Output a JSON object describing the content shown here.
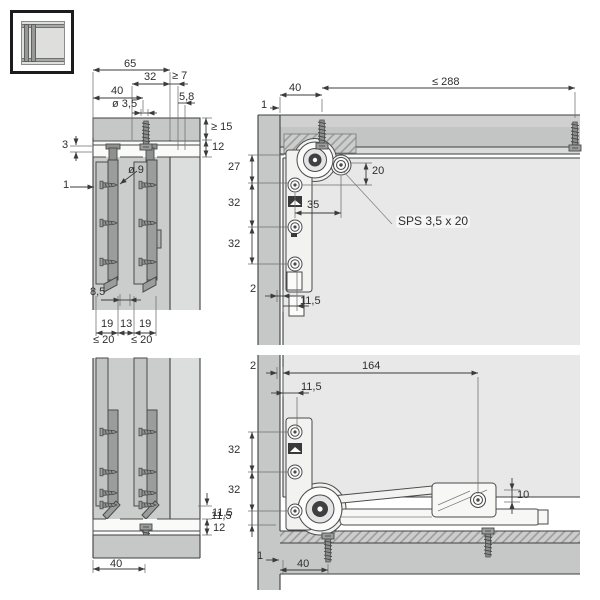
{
  "drawing_title": "Sliding door fitting installation drawing",
  "legend_icon": "sliding-door-cabinet-icon",
  "views": {
    "top_section": {
      "name": "top track cross-section",
      "labels": {
        "width_65": "65",
        "width_32": "32",
        "min_7": "≥ 7",
        "width_40": "40",
        "off_5_8": "5,8",
        "dia_3_5": "ø 3,5",
        "min_15": "≥ 15",
        "h_12": "12",
        "h_3": "3",
        "gap_1": "1",
        "dia_9": "ø 9",
        "off_8_5": "8,5",
        "t_19a": "19",
        "t_13": "13",
        "t_19b": "19",
        "max_20a": "≤ 20",
        "max_20b": "≤ 20"
      }
    },
    "top_side": {
      "name": "top fitting side view",
      "labels": {
        "w_40": "40",
        "gap_1": "1",
        "max_288": "≤ 288",
        "h_27": "27",
        "h_32a": "32",
        "h_32b": "32",
        "v_20": "20",
        "w_35": "35",
        "gap_2": "2",
        "off_11_5": "11,5"
      },
      "screw_note": "SPS 3,5 x 20"
    },
    "bottom_section": {
      "name": "bottom track cross-section",
      "labels": {
        "h_11_5": "11,5",
        "h_12": "12",
        "w_40": "40"
      }
    },
    "bottom_side": {
      "name": "bottom fitting side view",
      "labels": {
        "gap_2": "2",
        "w_164": "164",
        "off_11_5": "11,5",
        "h_32a": "32",
        "h_32b": "32",
        "h_11_5": "11,5",
        "v_10": "10",
        "gap_1": "1",
        "w_40": "40"
      }
    }
  }
}
